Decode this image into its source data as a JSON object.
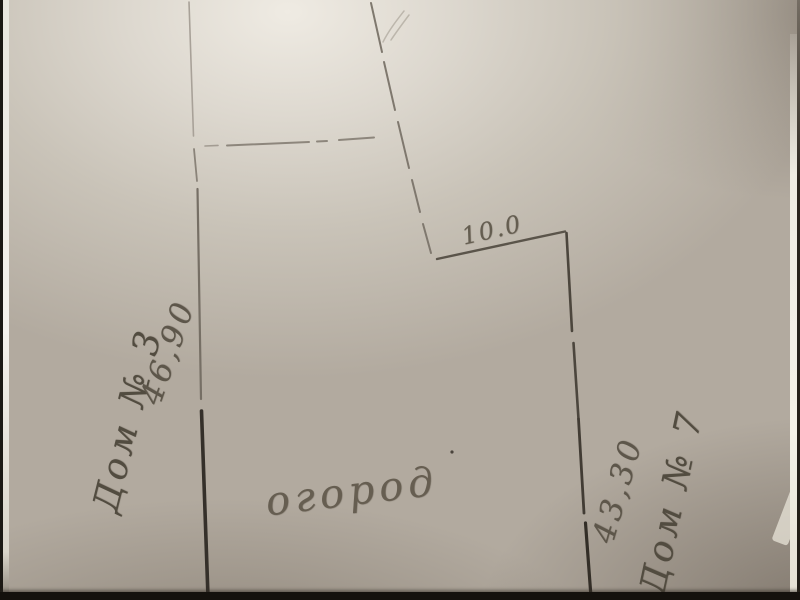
{
  "sketch": {
    "labels": {
      "house_left": "Дом № 3",
      "dim_left": "46,90",
      "dim_top": "10.0",
      "garden": "огород",
      "dim_right": "43,30",
      "house_right": "Дом № 7"
    },
    "colors": {
      "paper_light": "#efebe3",
      "paper_mid": "#b2aa9f",
      "paper_dark": "#857c72",
      "pencil": "#766f65",
      "pencil_bold": "#35302a",
      "frame_black": "#14110d",
      "frame_white": "#f4f2ec"
    }
  }
}
